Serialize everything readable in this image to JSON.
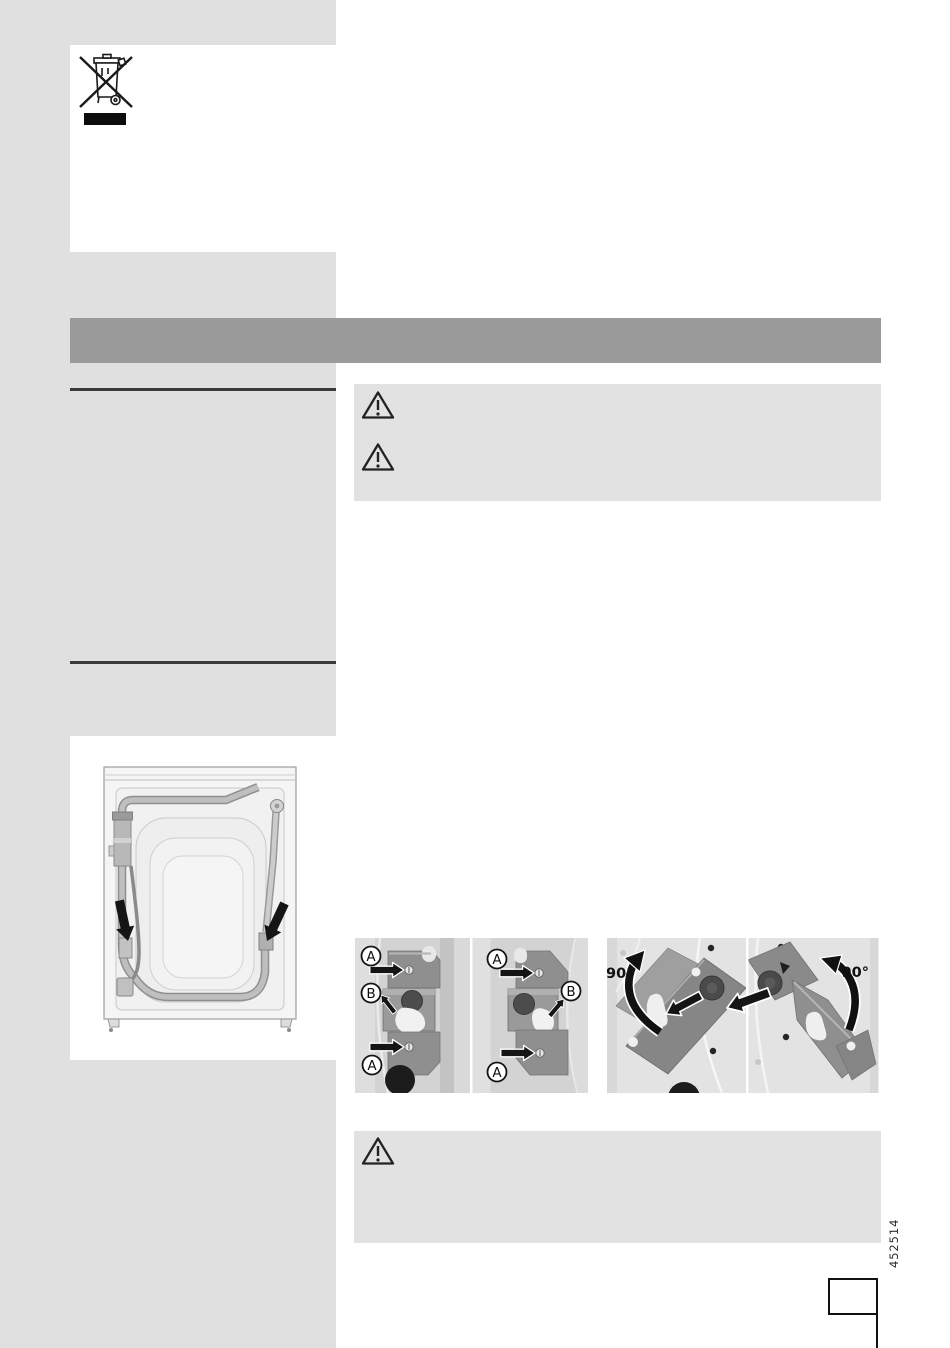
{
  "page": {
    "width": 950,
    "height": 1348,
    "background": "#ffffff"
  },
  "colors": {
    "sidebar": "#e0e0e0",
    "banner": "#9a9a9a",
    "warning_box": "#e2e2e2",
    "rule": "#3a3a3a",
    "arrow_black": "#151515"
  },
  "icons": {
    "weee": "weee-crossed-out-wheeled-bin-icon",
    "warning": "warning-triangle-icon",
    "figure": "washing-machine-rear-view-illustration",
    "bracket_panels": "transit-bracket-removal-illustrations"
  },
  "panels": {
    "p1_a_top": "A",
    "p1_b": "B",
    "p1_a_bottom": "A",
    "p2_a_top": "A",
    "p2_b": "B",
    "p2_a_bottom": "A",
    "p3_angle": "90°",
    "p4_angle": "90°"
  },
  "side_code": "452514"
}
